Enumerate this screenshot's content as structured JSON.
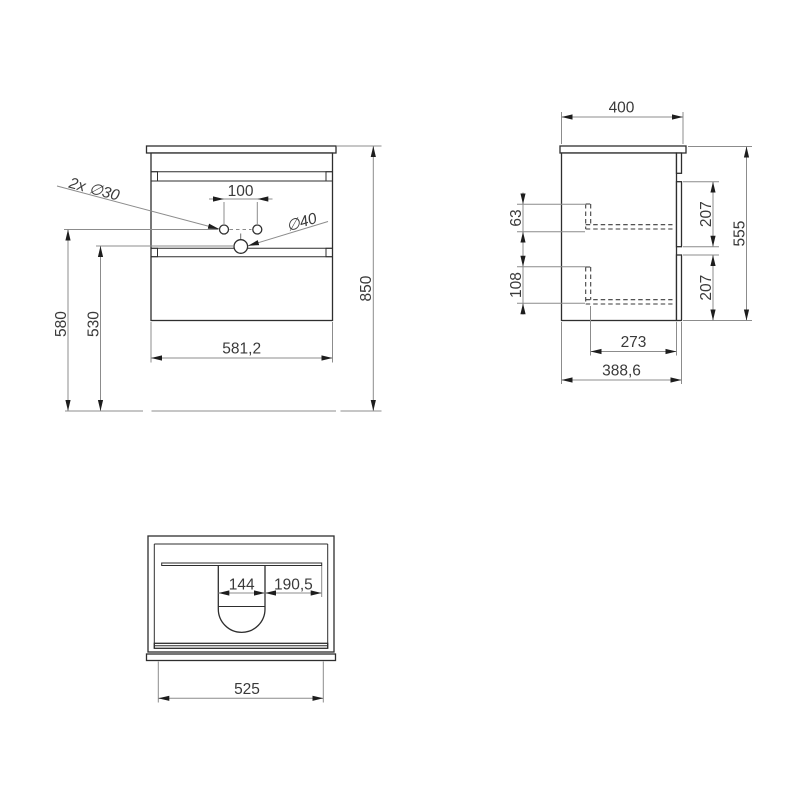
{
  "drawing": {
    "front_view": {
      "cabinet_width": "581,2",
      "total_height": "850",
      "faucet_hole_height": "580",
      "drain_hole_height": "530",
      "faucet_hole_spacing": "100",
      "faucet_holes_label": "2x ∅30",
      "drain_hole_label": "∅40"
    },
    "side_view": {
      "depth": "400",
      "body_height": "555",
      "front_panel_upper": "207",
      "front_panel_lower": "207",
      "offset_upper": "63",
      "offset_lower": "108",
      "inner_depth": "273",
      "body_depth": "388,6"
    },
    "top_view": {
      "basin_cutout_width": "144",
      "basin_right_offset": "190,5",
      "inner_width": "525"
    },
    "colors": {
      "object_line": "#2e2e2e",
      "dimension_line": "#8c8c8c",
      "text": "#3a3a3a",
      "background": "#ffffff"
    }
  }
}
